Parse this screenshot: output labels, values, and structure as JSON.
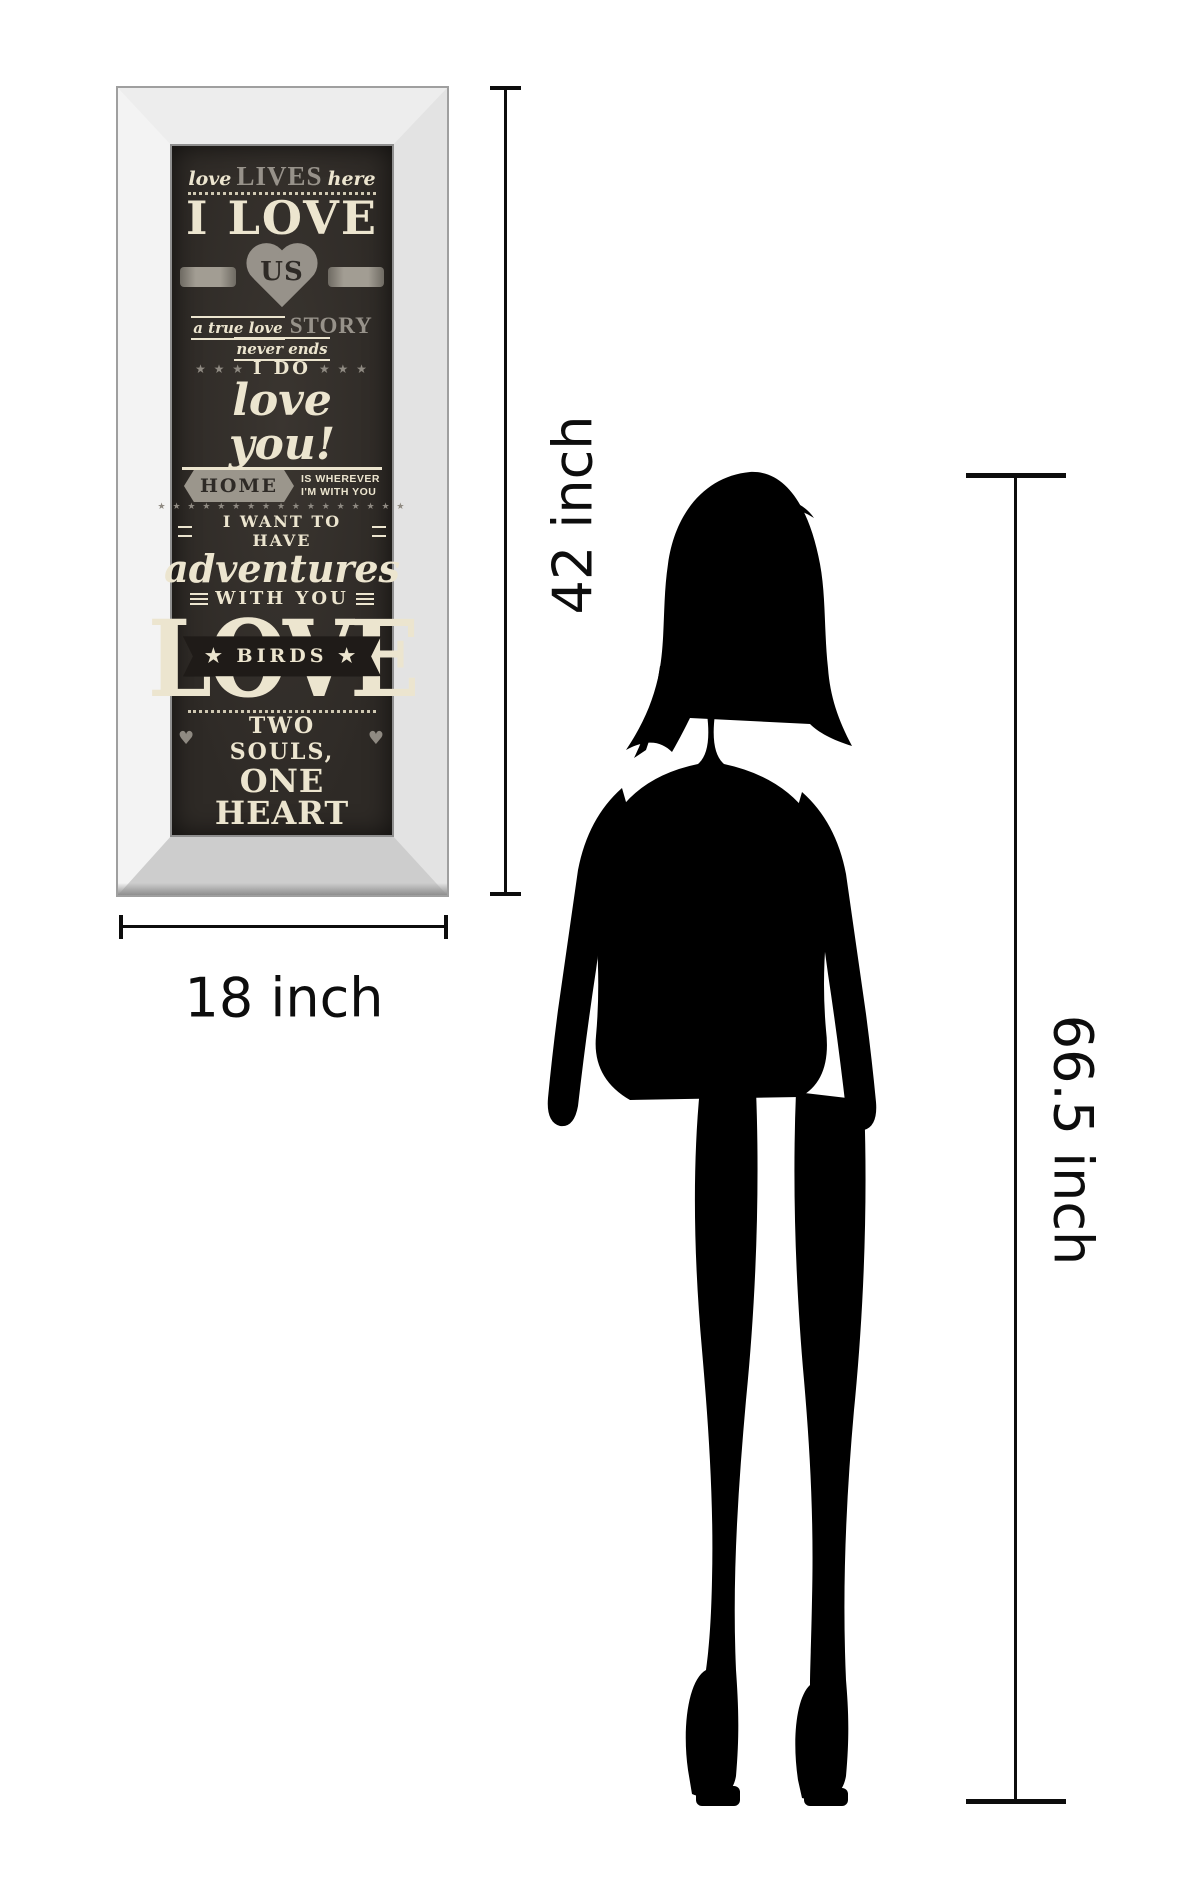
{
  "colors": {
    "poster_bg": "#2e2a26",
    "cream_ink": "#ece5cf",
    "gray_ink": "#97928a",
    "dimension_ink": "#0d0d0d",
    "silhouette": "#000000"
  },
  "poster": {
    "line1": {
      "pre": "love",
      "mid": "LIVES",
      "post": "here"
    },
    "line2": "I LOVE",
    "heart_word": "US",
    "line3": {
      "pre": "a true love",
      "mid": "STORY",
      "post": "never ends"
    },
    "line4": {
      "stars": "★ ★ ★",
      "text": "I DO"
    },
    "line5": "love you!",
    "home": {
      "banner": "HOME",
      "right_line1": "IS WHEREVER",
      "right_line2": "I'M WITH YOU"
    },
    "stars_row": "★ ★ ★ ★ ★ ★ ★ ★ ★ ★ ★ ★ ★ ★ ★ ★ ★",
    "line6": "I WANT TO HAVE",
    "line7": "adventures",
    "line8": "WITH YOU",
    "love_word": "LOVE",
    "birds_banner": "★ BIRDS ★",
    "line9": {
      "heart": "♥",
      "text": "TWO SOULS,"
    },
    "line10": "ONE HEART"
  },
  "dimensions": {
    "art_height_label": "42 inch",
    "art_width_label": "18 inch",
    "person_height_label": "66.5 inch"
  },
  "figure": {
    "name": "woman silhouette"
  }
}
